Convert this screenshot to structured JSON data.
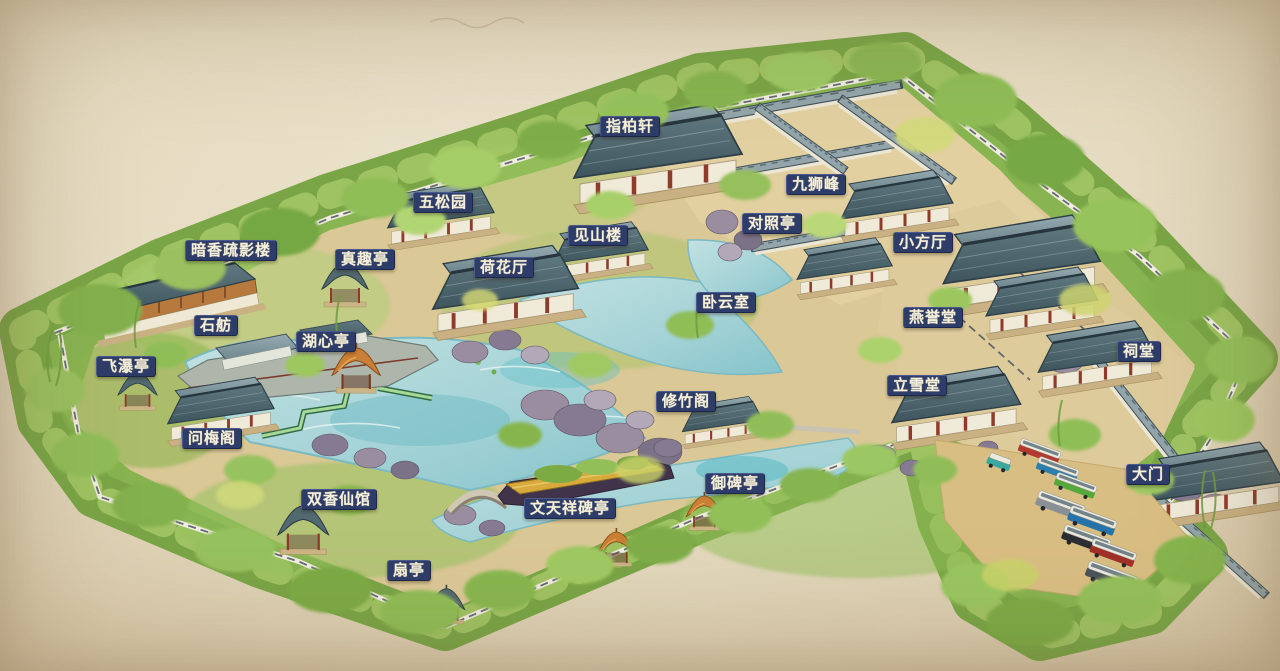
{
  "meta": {
    "width": 1280,
    "height": 671,
    "kind": "illustrated-garden-map"
  },
  "map": {
    "style": {
      "label_background": "#2e3c69",
      "label_text": "#f4efdb",
      "label_border": "#4a5a8f",
      "paper": "#e9dfc4",
      "foliage": "#8ab553",
      "water": "#a6d2d4",
      "roof": "#4f676f",
      "ground": "#dbc897"
    },
    "labels": [
      {
        "id": "zhibaixuan",
        "text": "指柏轩",
        "x": 600,
        "y": 116
      },
      {
        "id": "wusongyuan",
        "text": "五松园",
        "x": 413,
        "y": 192
      },
      {
        "id": "jiushifeng",
        "text": "九狮峰",
        "x": 786,
        "y": 174
      },
      {
        "id": "duizhaoting",
        "text": "对照亭",
        "x": 742,
        "y": 213
      },
      {
        "id": "jianshanlou",
        "text": "见山楼",
        "x": 568,
        "y": 225
      },
      {
        "id": "xiaofangting",
        "text": "小方厅",
        "x": 893,
        "y": 232
      },
      {
        "id": "anxiangshuyinglou",
        "text": "暗香疏影楼",
        "x": 185,
        "y": 240
      },
      {
        "id": "zhenquting",
        "text": "真趣亭",
        "x": 335,
        "y": 249
      },
      {
        "id": "hehuating",
        "text": "荷花厅",
        "x": 474,
        "y": 257
      },
      {
        "id": "woyunshi",
        "text": "卧云室",
        "x": 696,
        "y": 292
      },
      {
        "id": "yanyutang",
        "text": "燕誉堂",
        "x": 903,
        "y": 307
      },
      {
        "id": "shifang",
        "text": "石舫",
        "x": 194,
        "y": 315
      },
      {
        "id": "huxinting",
        "text": "湖心亭",
        "x": 296,
        "y": 331
      },
      {
        "id": "citang",
        "text": "祠堂",
        "x": 1117,
        "y": 341
      },
      {
        "id": "feiputing",
        "text": "飞瀑亭",
        "x": 96,
        "y": 356
      },
      {
        "id": "lixuetang",
        "text": "立雪堂",
        "x": 887,
        "y": 375
      },
      {
        "id": "xiuzhuge",
        "text": "修竹阁",
        "x": 656,
        "y": 391
      },
      {
        "id": "wenmeige",
        "text": "问梅阁",
        "x": 182,
        "y": 428
      },
      {
        "id": "damen",
        "text": "大门",
        "x": 1126,
        "y": 464
      },
      {
        "id": "yubeiting",
        "text": "御碑亭",
        "x": 705,
        "y": 473
      },
      {
        "id": "shuangxiangxianguan",
        "text": "双香仙馆",
        "x": 301,
        "y": 489
      },
      {
        "id": "wentianxiangbeiting",
        "text": "文天祥碑亭",
        "x": 524,
        "y": 498
      },
      {
        "id": "shanting",
        "text": "扇亭",
        "x": 387,
        "y": 560
      }
    ],
    "parking": {
      "vehicle_colors": [
        "#3aa8a0",
        "#b23a30",
        "#2e7fae",
        "#57a83c",
        "#eceadf"
      ]
    }
  }
}
